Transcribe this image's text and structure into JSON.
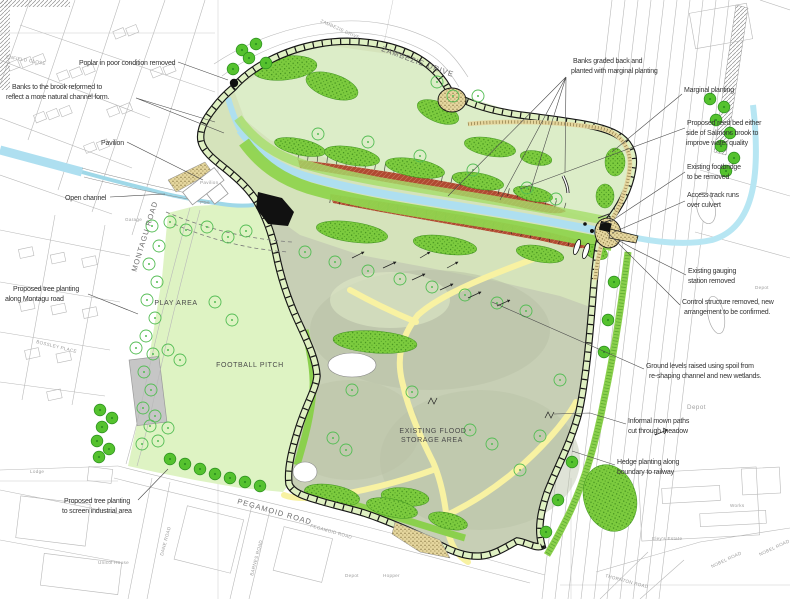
{
  "drawing": {
    "type": "landscape-masterplan",
    "subject": "Salmons Brook flood storage area improvement plan"
  },
  "colors": {
    "recreation_green": "#dcf2c2",
    "meadow_grey_green": "#c7cfb5",
    "bank_green": "#7ccb3e",
    "reed_bed_red": "#b04a31",
    "water_blue": "#aedff0",
    "mown_path_yellow": "#f8f2a2",
    "stipple_tan": "#e5d69e",
    "path_black": "#161616",
    "basemap_grey": "#b9b9b9"
  },
  "area_labels": {
    "play_area": "PLAY AREA",
    "football_pitch": "FOOTBALL PITCH",
    "flood_storage_line1": "EXISTING FLOOD",
    "flood_storage_line2": "STORAGE AREA"
  },
  "road_labels": {
    "zambezie_drive": "ZAMBEZIE DRIVE",
    "zambezie_drive_small": "ZAMBEZIE DRIVE",
    "montagu_road": "MONTAGU ROAD",
    "pegamoid_road": "PEGAMOID ROAD",
    "pegamoid_road_small": "PEGAMOID ROAD",
    "thornton_road": "THORNTON ROAD",
    "nobel_road_a": "NOBEL ROAD",
    "nobel_road_b": "NOBEL ROAD",
    "dane_road": "DANE ROAD",
    "barnes_road": "BARNES ROAD",
    "enfield_close": "ENFIELD CLOSE",
    "bossley_place": "BOSSLEY PLACE"
  },
  "place_labels": {
    "pavilion": "Pavilion",
    "pcs": "PCs",
    "garage": "Garage",
    "depot_right": "Depot",
    "depot_far": "Depot",
    "depot_bottom": "Depot",
    "hopper": "Hopper",
    "eleys_estate": "Eley's Estate",
    "works": "Works",
    "lodge": "Lodge",
    "unicol_house": "Unicol House"
  },
  "annotations": [
    {
      "id": "poplar",
      "lines": [
        "Poplar in poor condition removed"
      ]
    },
    {
      "id": "banks-brook",
      "lines": [
        "Banks to the brook reformed to",
        "reflect a more natural channel form."
      ]
    },
    {
      "id": "pavilion",
      "lines": [
        "Pavilion"
      ]
    },
    {
      "id": "open-channel",
      "lines": [
        "Open channel"
      ]
    },
    {
      "id": "montagu-trees",
      "lines": [
        "Proposed tree planting",
        "along Montagu road"
      ]
    },
    {
      "id": "screen-trees",
      "lines": [
        "Proposed tree planting",
        "to screen industrial area"
      ]
    },
    {
      "id": "banks-graded",
      "lines": [
        "Banks graded back and",
        "planted with marginal planting"
      ]
    },
    {
      "id": "marginal-planting",
      "lines": [
        "Marginal planting"
      ]
    },
    {
      "id": "reed-bed",
      "lines": [
        "Proposed reed bed either",
        "side of Salmons brook to",
        "improve water quality"
      ]
    },
    {
      "id": "footbridge",
      "lines": [
        "Existing footbridge",
        "to be removed"
      ]
    },
    {
      "id": "access-track",
      "lines": [
        "Access track runs",
        "over culvert"
      ]
    },
    {
      "id": "gauging",
      "lines": [
        "Existing gauging",
        "station removed"
      ]
    },
    {
      "id": "control",
      "lines": [
        "Control structure removed, new",
        "arrangement to be confirmed."
      ]
    },
    {
      "id": "ground-levels",
      "lines": [
        "Ground levels raised using spoil from",
        "re-shaping channel and new wetlands."
      ]
    },
    {
      "id": "mown-paths",
      "lines": [
        "Informal mown paths",
        "cut through meadow"
      ]
    },
    {
      "id": "hedge",
      "lines": [
        "Hedge planting along",
        "boundary to railway"
      ]
    }
  ]
}
